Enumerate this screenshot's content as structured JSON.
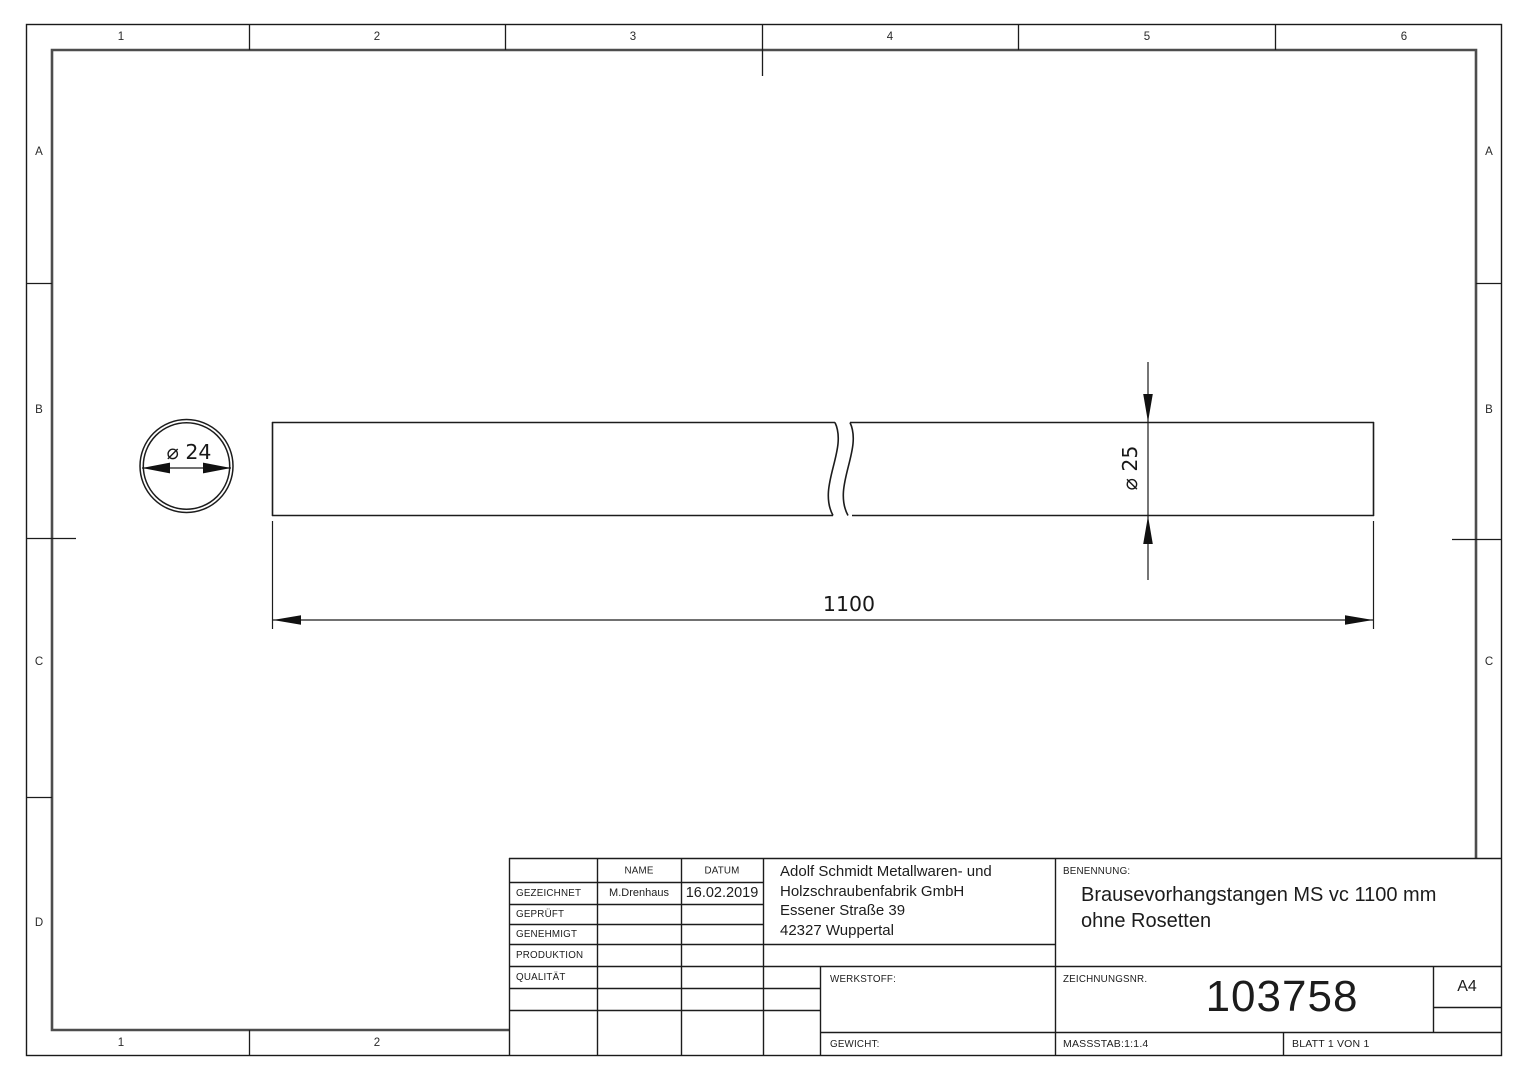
{
  "grid": {
    "cols_top": [
      "1",
      "2",
      "3",
      "4",
      "5",
      "6"
    ],
    "cols_bottom": [
      "1",
      "2"
    ],
    "rows_left": [
      "A",
      "B",
      "C",
      "D"
    ],
    "rows_right": [
      "A",
      "B",
      "C"
    ]
  },
  "drawing": {
    "dim_end_diameter": "⌀ 24",
    "dim_side_diameter": "⌀ 25",
    "dim_length": "1100"
  },
  "title_block": {
    "col_headers": {
      "name": "NAME",
      "datum": "DATUM"
    },
    "approval_rows": [
      {
        "label": "GEZEICHNET",
        "name": "M.Drenhaus",
        "datum": "16.02.2019"
      },
      {
        "label": "GEPRÜFT",
        "name": "",
        "datum": ""
      },
      {
        "label": "GENEHMIGT",
        "name": "",
        "datum": ""
      },
      {
        "label": "PRODUKTION",
        "name": "",
        "datum": ""
      },
      {
        "label": "QUALITÄT",
        "name": "",
        "datum": ""
      }
    ],
    "company": [
      "Adolf Schmidt Metallwaren- und",
      "Holzschraubenfabrik GmbH",
      "Essener Straße 39",
      "42327 Wuppertal"
    ],
    "benennung_label": "BENENNUNG:",
    "part_title": [
      "Brausevorhangstangen MS vc 1100 mm",
      "ohne Rosetten"
    ],
    "werkstoff_label": "WERKSTOFF:",
    "gewicht_label": "GEWICHT:",
    "zeichnungsnr_label": "ZEICHNUNGSNR.",
    "drawing_number": "103758",
    "paper_format": "A4",
    "massstab": "MASSSTAB:1:1.4",
    "blatt": "BLATT 1 VON 1"
  }
}
